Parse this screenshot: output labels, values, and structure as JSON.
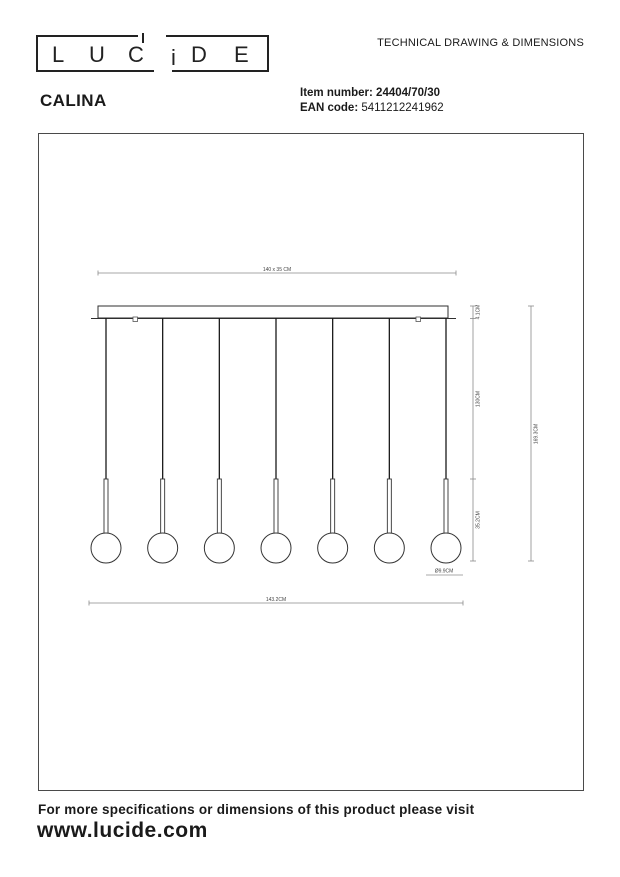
{
  "header": {
    "logo_letters": [
      "L",
      "U",
      "C",
      "i",
      "D",
      "E"
    ],
    "doc_title": "TECHNICAL DRAWING & DIMENSIONS"
  },
  "product": {
    "name": "CALINA",
    "item_label": "Item number:",
    "item_number": "24404/70/30",
    "ean_label": "EAN code:",
    "ean_code": "5411212241962"
  },
  "drawing": {
    "pendant_count": 7,
    "dims": {
      "base_plate": "140 x 35 CM",
      "canopy_height": "4.1CM",
      "cable_section": "130CM",
      "lamp_section": "35.2CM",
      "total_height": "169.3CM",
      "total_width": "143.2CM",
      "globe_diameter": "Ø9.9CM"
    }
  },
  "footer": {
    "line1": "For more specifications or dimensions of this product please visit",
    "line2": "www.lucide.com"
  },
  "colors": {
    "ink": "#1a1a1a",
    "fixture_line": "#2f2f2f",
    "dim_line": "#8a8a8a",
    "dim_text": "#444444"
  }
}
